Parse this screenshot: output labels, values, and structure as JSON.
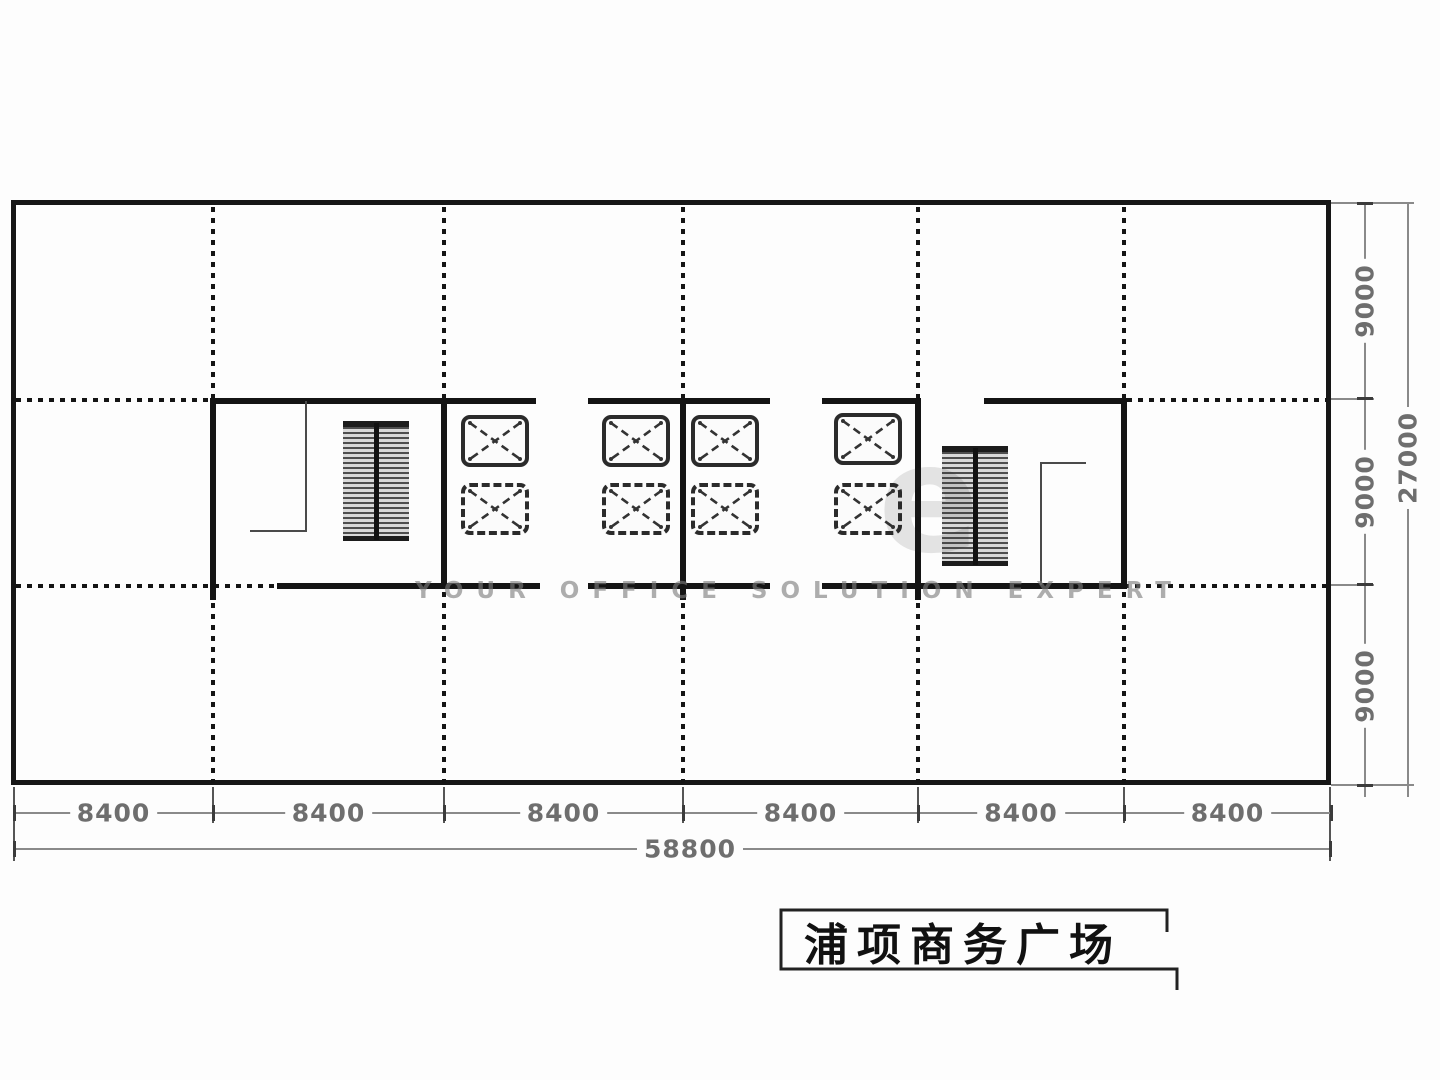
{
  "drawing": {
    "title": "浦项商务广场",
    "watermark_small": "YOUR OFFICE SOLUTION EXPERT",
    "watermark_large": "e"
  },
  "dimensions": {
    "bottom_bays": [
      "8400",
      "8400",
      "8400",
      "8400",
      "8400",
      "8400"
    ],
    "bottom_total": "58800",
    "right_bays": [
      "9000",
      "9000",
      "9000"
    ],
    "right_total": "27000"
  },
  "icons": {
    "elevator": "elevator-shaft-icon",
    "stair": "stair-icon"
  },
  "colors": {
    "wall_line": "#141414",
    "dim_line": "#8a8a8a",
    "dim_text": "#6e6e6e",
    "watermark": "#7d7d7d"
  }
}
